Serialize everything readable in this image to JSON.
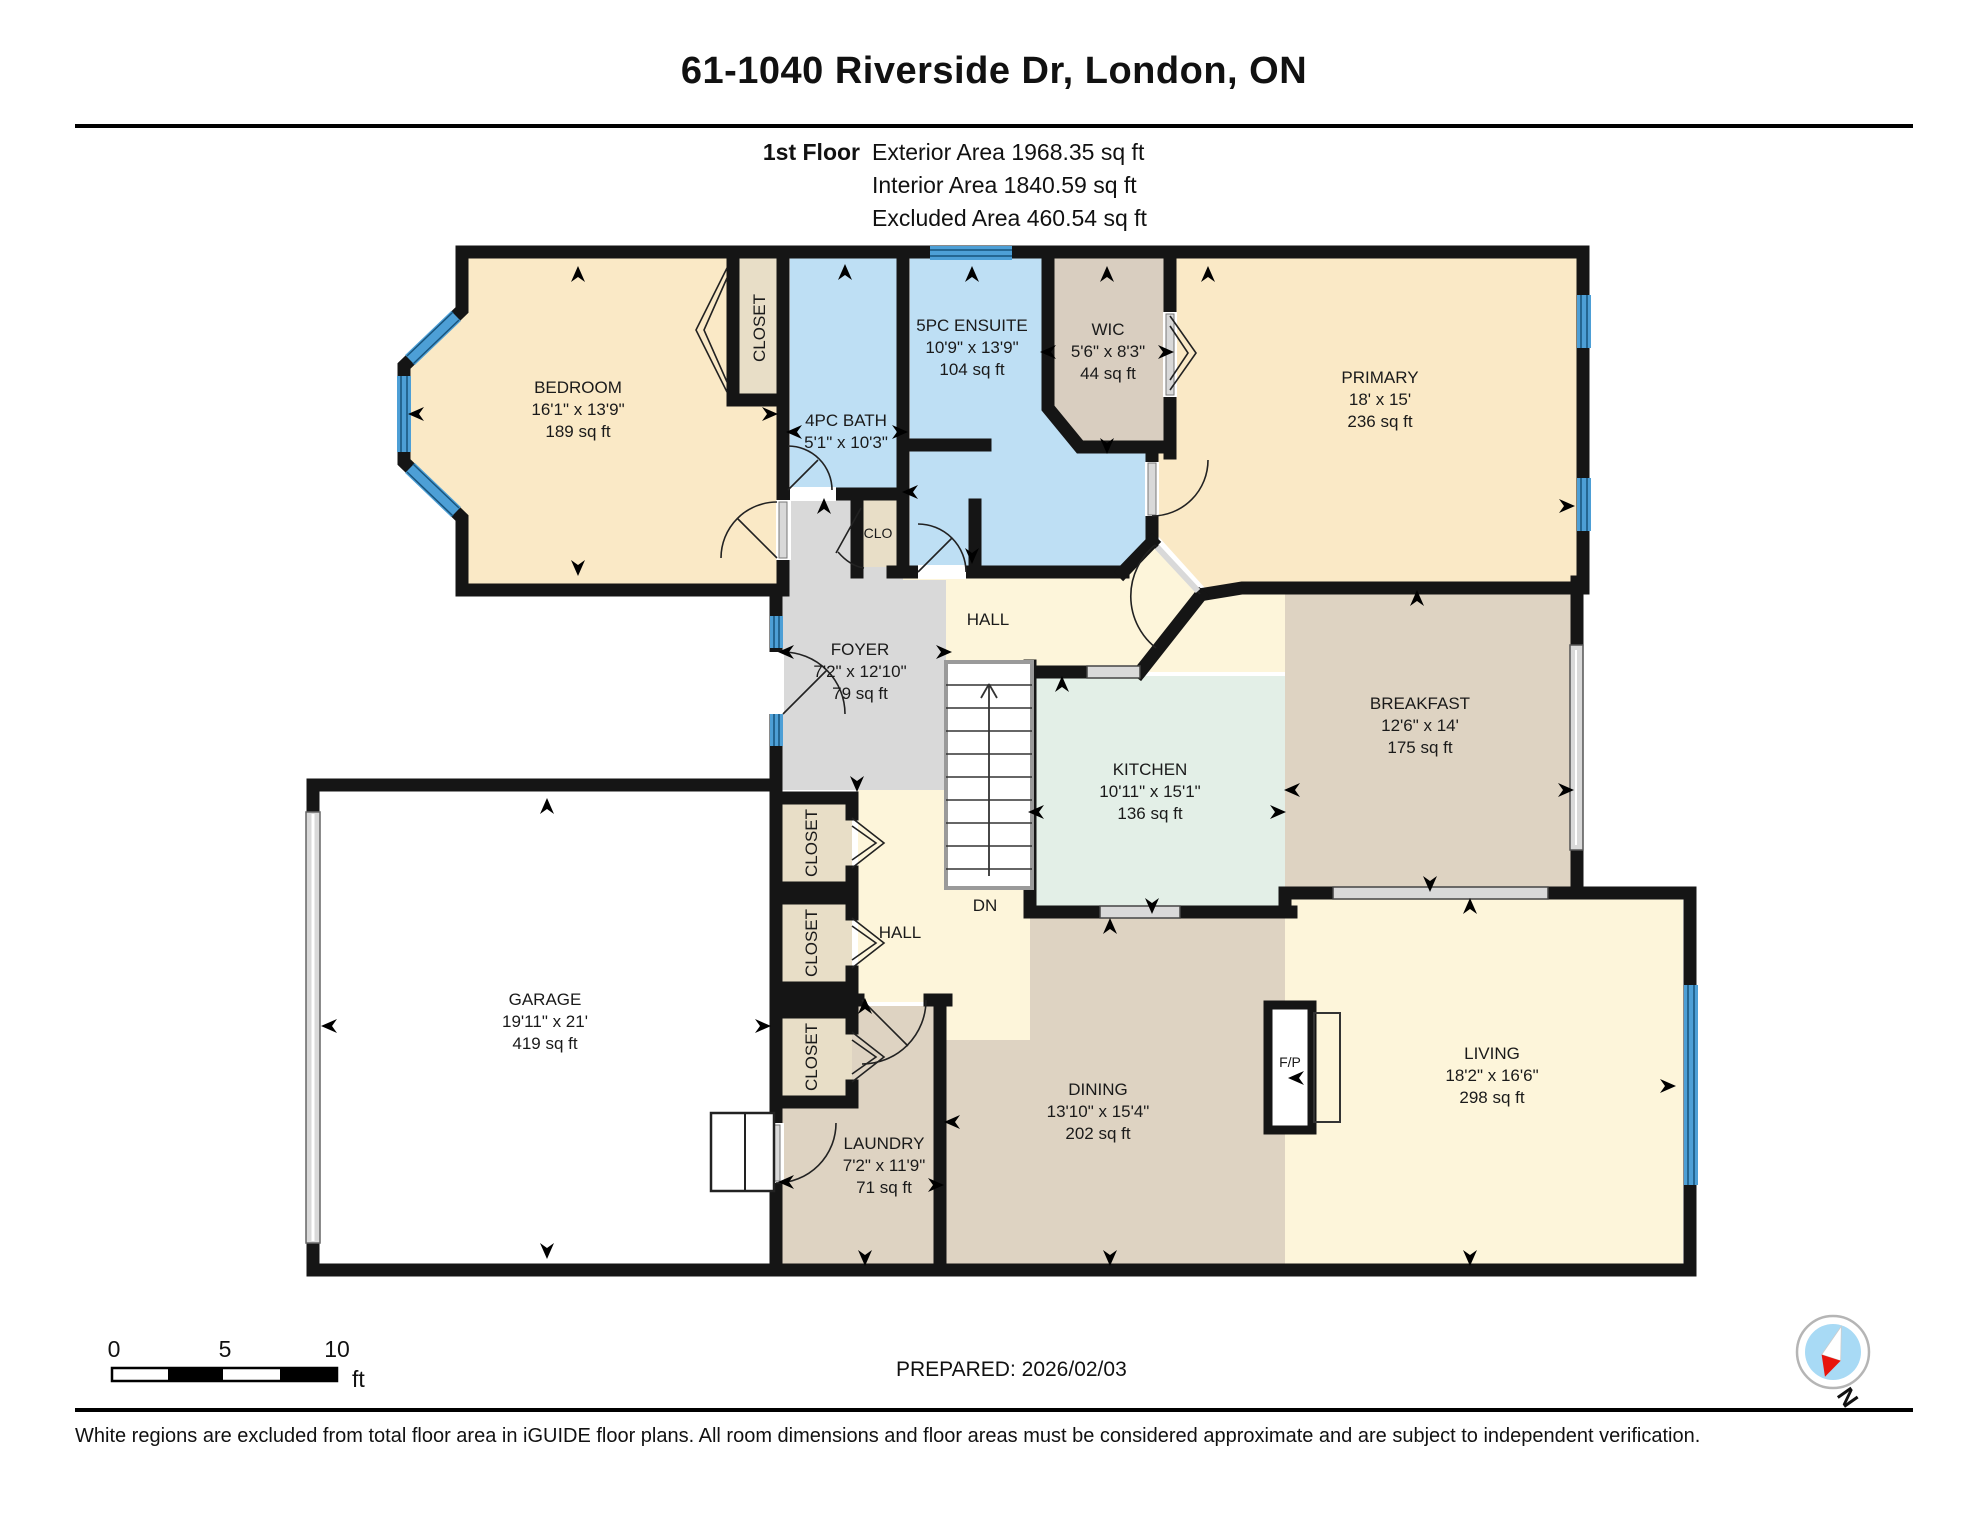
{
  "header": {
    "title": "61-1040 Riverside Dr, London, ON",
    "floor_label": "1st Floor",
    "exterior_area": "Exterior Area 1968.35 sq ft",
    "interior_area": "Interior Area 1840.59 sq ft",
    "excluded_area": "Excluded Area 460.54 sq ft"
  },
  "rooms": {
    "bedroom": {
      "name": "BEDROOM",
      "dims": "16'1\" x 13'9\"",
      "area": "189 sq ft"
    },
    "closet_bedroom": {
      "name": "CLOSET"
    },
    "bath": {
      "name": "4PC BATH",
      "dims": "5'1\" x 10'3\""
    },
    "ensuite": {
      "name": "5PC ENSUITE",
      "dims": "10'9\" x 13'9\"",
      "area": "104 sq ft"
    },
    "wic": {
      "name": "WIC",
      "dims": "5'6\" x 8'3\"",
      "area": "44 sq ft"
    },
    "clo": {
      "name": "CLO"
    },
    "primary": {
      "name": "PRIMARY",
      "dims": "18' x 15'",
      "area": "236 sq ft"
    },
    "hall_upper": {
      "name": "HALL"
    },
    "foyer": {
      "name": "FOYER",
      "dims": "7'2\" x 12'10\"",
      "area": "79 sq ft"
    },
    "stairs": {
      "down_label": "DN"
    },
    "kitchen": {
      "name": "KITCHEN",
      "dims": "10'11\" x 15'1\"",
      "area": "136 sq ft"
    },
    "breakfast": {
      "name": "BREAKFAST",
      "dims": "12'6\" x 14'",
      "area": "175 sq ft"
    },
    "garage": {
      "name": "GARAGE",
      "dims": "19'11\" x 21'",
      "area": "419 sq ft"
    },
    "closet1": {
      "name": "CLOSET"
    },
    "closet2": {
      "name": "CLOSET"
    },
    "closet3": {
      "name": "CLOSET"
    },
    "hall_lower": {
      "name": "HALL"
    },
    "laundry": {
      "name": "LAUNDRY",
      "dims": "7'2\" x 11'9\"",
      "area": "71 sq ft"
    },
    "dining": {
      "name": "DINING",
      "dims": "13'10\" x 15'4\"",
      "area": "202 sq ft"
    },
    "living": {
      "name": "LIVING",
      "dims": "18'2\" x 16'6\"",
      "area": "298 sq ft"
    },
    "fireplace": {
      "name": "F/P"
    }
  },
  "scale_bar": {
    "tick0": "0",
    "tick5": "5",
    "tick10": "10",
    "unit": "ft"
  },
  "prepared": "PREPARED: 2026/02/03",
  "compass": {
    "label": "N"
  },
  "disclaimer": "White regions are excluded from total floor area in iGUIDE floor plans. All room dimensions and floor areas must be considered approximate and are subject to independent verification.",
  "colors": {
    "bedroom_fill": "#fae9c6",
    "hall_fill": "#fdf5da",
    "bath_fill": "#bedff4",
    "tan_fill": "#ded3c2",
    "closet_fill": "#e8dec7",
    "kitchen_fill": "#e3efe7",
    "foyer_fill": "#d9d9d9",
    "window_blue": "#4d9fd6",
    "wall": "#151515",
    "compass_blue": "#a8daf5",
    "compass_red": "#e8140c"
  }
}
